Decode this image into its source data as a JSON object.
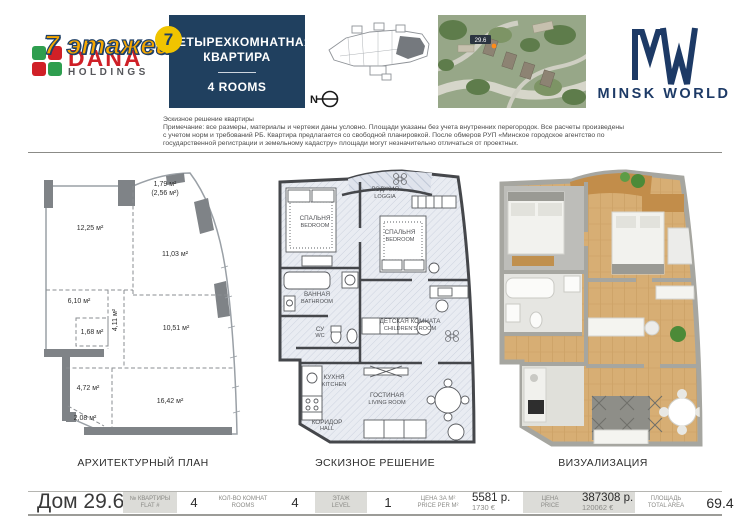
{
  "colors": {
    "navy": "#20405f",
    "logo_navy": "#1d3a66",
    "yellow_badge": "#f0c400",
    "overlay_orange": "#f7a800",
    "logo_green": "#2e9e4f",
    "logo_red": "#d02027",
    "cell_gray": "#dcdcd8",
    "plan_wall_gray": "#7f8387",
    "sketch_wall": "#45474b",
    "wood_floor": "#d7ae74"
  },
  "header": {
    "dana": {
      "overlay": "7 этажей",
      "brand": "DANA",
      "sub": "HOLDINGS"
    },
    "apartment_box": {
      "badge": "7",
      "title1": "ЧЕТЫРЕХКОМНАТНАЯ",
      "title2": "КВАРТИРА",
      "subtitle": "4 ROOMS"
    },
    "north_label": "N",
    "map_label": "29.6",
    "brand_right": {
      "name": "MINSK WORLD"
    }
  },
  "disclaimer": {
    "line1": "Эскизное решение квартиры",
    "line2": "Примечание: все размеры, материалы и чертежи даны условно. Площади указаны без учета внутренних перегородок. Все расчеты произведены",
    "line3": "с учетом норм и требований РБ. Квартира предлагается со свободной планировкой. После обмеров РУП «Минское городское агентство по",
    "line4": "государственной регистрации и земельному кадастру» площади могут незначительно отличаться от проектных."
  },
  "plans": {
    "architectural": {
      "caption": "АРХИТЕКТУРНЫЙ ПЛАН",
      "areas": {
        "loggia_a": "1,79 м²",
        "loggia_b": "(2,56 м²)",
        "r1": "12,25 м²",
        "r2": "11,03 м²",
        "r3": "6,10 м²",
        "r4": "4,11 м²",
        "r5": "1,68 м²",
        "r6": "10,51 м²",
        "r7": "4,72 м²",
        "r8": "16,42 м²",
        "r9": "2,08 м²"
      }
    },
    "sketch": {
      "caption": "ЭСКИЗНОЕ РЕШЕНИЕ",
      "rooms": {
        "loggia": {
          "ru": "ЛОДЖИЯ",
          "en": "LOGGIA"
        },
        "bedroom1": {
          "ru": "СПАЛЬНЯ",
          "en": "BEDROOM"
        },
        "bedroom2": {
          "ru": "СПАЛЬНЯ",
          "en": "BEDROOM"
        },
        "bathroom": {
          "ru": "ВАННАЯ",
          "en": "BATHROOM"
        },
        "wc": {
          "ru": "СУ",
          "en": "WC"
        },
        "children": {
          "ru": "ДЕТСКАЯ КОМНАТА",
          "en": "CHILDREN'S ROOM"
        },
        "kitchen": {
          "ru": "КУХНЯ",
          "en": "KITCHEN"
        },
        "living": {
          "ru": "ГОСТИНАЯ",
          "en": "LIVING ROOM"
        },
        "hall": {
          "ru": "КОРИДОР",
          "en": "HALL"
        }
      }
    },
    "visualization": {
      "caption": "ВИЗУАЛИЗАЦИЯ"
    }
  },
  "footer": {
    "building": "Дом 29.6",
    "cells": [
      {
        "label_ru": "№ КВАРТИРЫ",
        "label_en": "FLAT #",
        "value": "4"
      },
      {
        "label_ru": "КОЛ-ВО КОМНАТ",
        "label_en": "ROOMS",
        "value": "4"
      },
      {
        "label_ru": "ЭТАЖ",
        "label_en": "LEVEL",
        "value": "1"
      },
      {
        "label_ru": "ЦЕНА ЗА М²",
        "label_en": "PRICE PER М²",
        "value": "5581 р.",
        "value_sub": "1730 €"
      },
      {
        "label_ru": "ЦЕНА",
        "label_en": "PRICE",
        "value": "387308 р.",
        "value_sub": "120062 €"
      },
      {
        "label_ru": "ПЛОЩАДЬ",
        "label_en": "TOTAL AREA",
        "value": "69.4"
      }
    ]
  }
}
